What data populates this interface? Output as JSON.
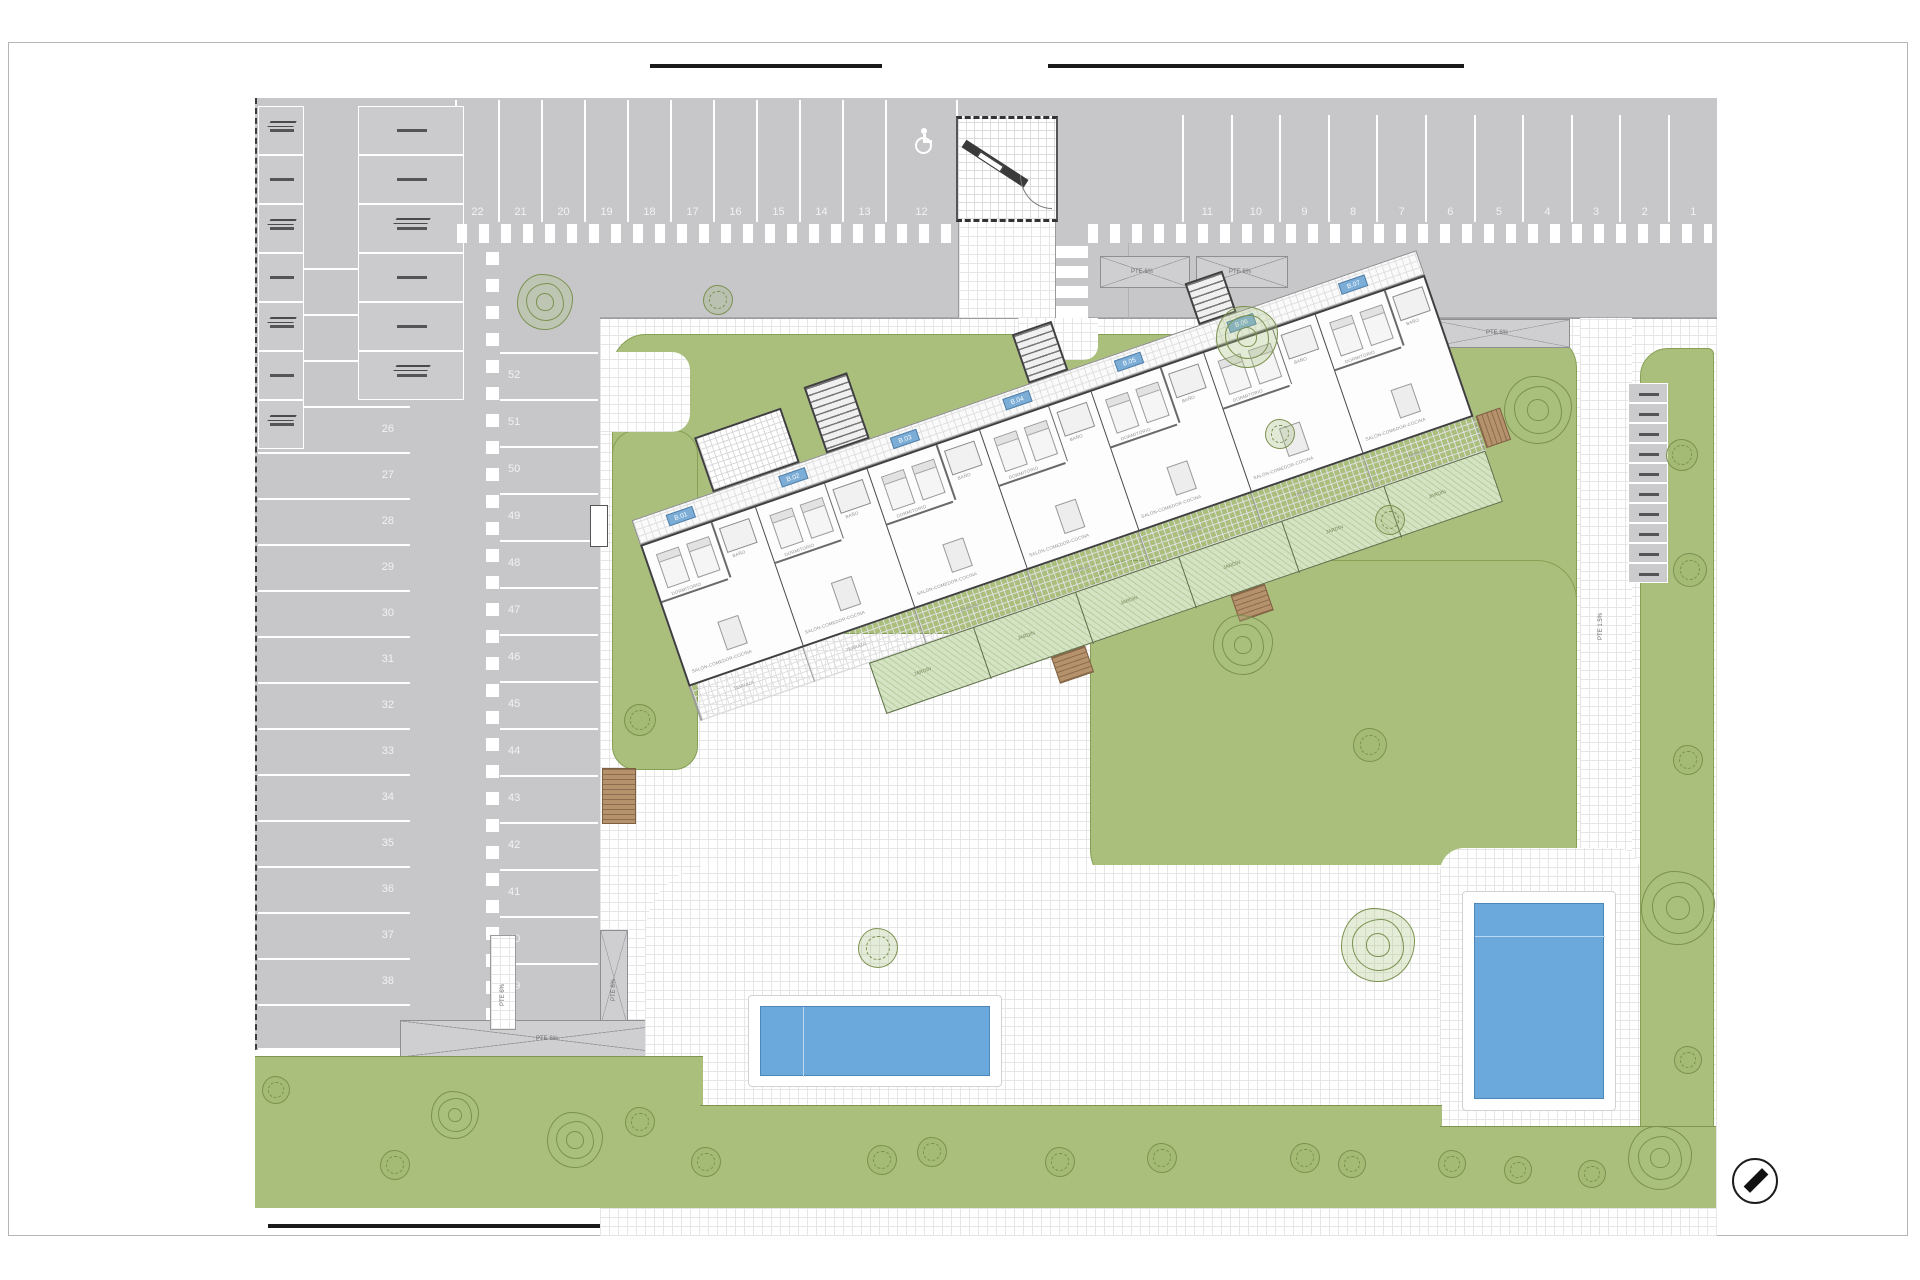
{
  "site": {
    "parking": {
      "row_top_left": [
        "22",
        "21",
        "20",
        "19",
        "18",
        "17",
        "16",
        "15",
        "14",
        "13"
      ],
      "accessible_space": "12",
      "row_top_right": [
        "11",
        "10",
        "9",
        "8",
        "7",
        "6",
        "5",
        "4",
        "3",
        "2",
        "1"
      ],
      "col_left": [
        "23",
        "24",
        "25",
        "26",
        "27",
        "28",
        "29",
        "30",
        "31",
        "32",
        "33",
        "34",
        "35",
        "36",
        "37",
        "38"
      ],
      "col_mid": [
        "52",
        "51",
        "50",
        "49",
        "48",
        "47",
        "46",
        "45",
        "44",
        "43",
        "42",
        "41",
        "40",
        "39"
      ]
    },
    "ramps": {
      "slope_6": "PTE 6%",
      "slope_15": "PTE 1.5%"
    },
    "building": {
      "unit_badges": [
        "B.01",
        "B.02",
        "B.03",
        "B.04",
        "B.05",
        "B.06",
        "B.07"
      ],
      "room_bedroom": "DORMITORIO",
      "room_living": "SALÓN-COMEDOR-COCINA",
      "room_bath": "BAÑO",
      "room_terrace": "TERRAZA",
      "room_garden": "JARDÍN"
    },
    "colors": {
      "paving": "#c7c7ca",
      "lawn": "#a9bf7b",
      "pool": "#6ba9dd",
      "garden_plot": "#d4e3c1",
      "badge": "#7badd7",
      "stair_wood": "#b5916c"
    }
  }
}
